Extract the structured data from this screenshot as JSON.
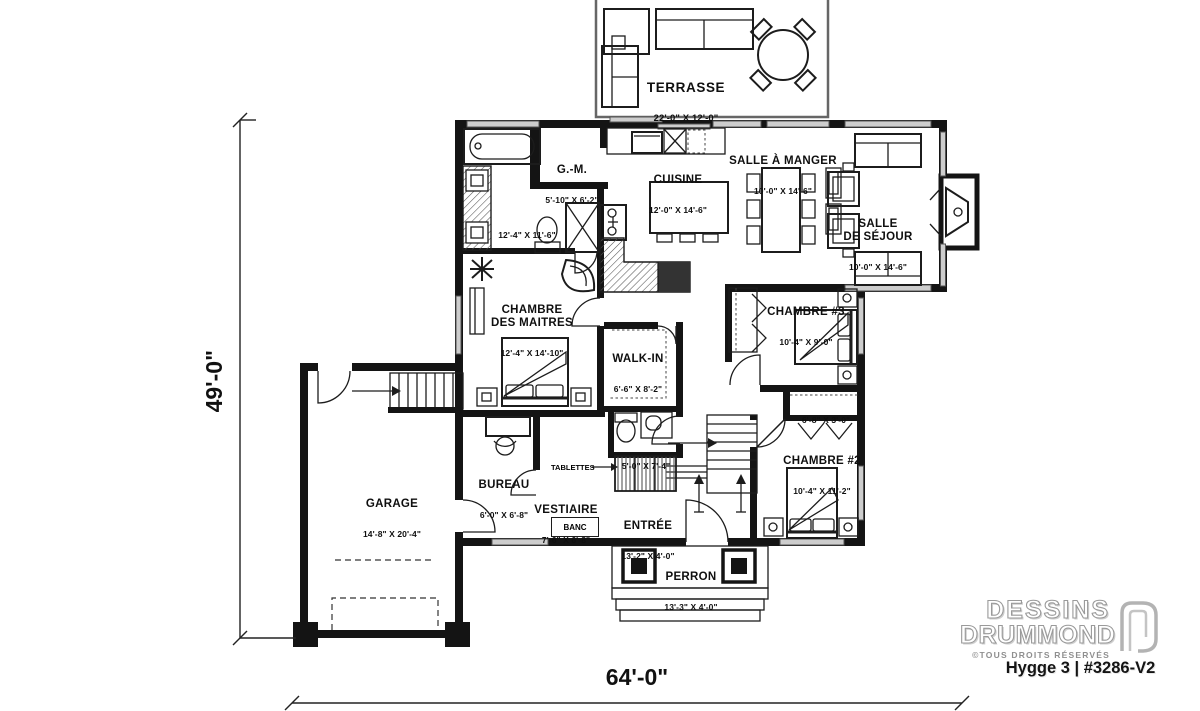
{
  "plan": {
    "rooms": {
      "terrasse": {
        "name": "TERRASSE",
        "dims": "22'-0\" X 12'-0\""
      },
      "gm": {
        "name": "G.-M.",
        "dims": "5'-10\" X 6'-2\""
      },
      "cuisine": {
        "name": "CUISINE",
        "dims": "12'-0\" X 14'-6\""
      },
      "salle_a_manger": {
        "name": "SALLE À MANGER",
        "dims": "10'-0\" X 14'-6\""
      },
      "salle_de_sejour": {
        "name": "SALLE\nDE SÉJOUR",
        "dims": "10'-0\" X 14'-6\""
      },
      "salle_de_bain": {
        "name": "",
        "dims": "12'-4\" X 11'-6\""
      },
      "chambre_maitres": {
        "name": "CHAMBRE\nDES MAITRES",
        "dims": "12'-4\" X 14'-10\""
      },
      "walk_in": {
        "name": "WALK-IN",
        "dims": "6'-6\" X 8'-2\""
      },
      "chambre3": {
        "name": "CHAMBRE #3",
        "dims": "10'-4\" X 9'-0\""
      },
      "placard": {
        "name": "",
        "dims": "6'-8\" X 3'-0\""
      },
      "chambre2": {
        "name": "CHAMBRE #2",
        "dims": "10'-4\" X 11'-2\""
      },
      "salle_eau": {
        "name": "",
        "dims": "5'-0\" X 7'-4\""
      },
      "bureau": {
        "name": "BUREAU",
        "dims": "6'-0\" X 6'-8\""
      },
      "vestiaire": {
        "name": "VESTIAIRE",
        "dims": "7'-6\" X 6'-8\""
      },
      "entree": {
        "name": "ENTRÉE",
        "dims": "13'-2\" X 4'-0\""
      },
      "garage": {
        "name": "GARAGE",
        "dims": "14'-8\" X 20'-4\""
      },
      "perron": {
        "name": "PERRON",
        "dims": "13'-3\" X 4'-0\""
      }
    },
    "annotations": {
      "tablettes": "TABLETTES",
      "banc": "BANC"
    },
    "overall_dimensions": {
      "width": "64'-0\"",
      "height": "49'-0\""
    }
  },
  "branding": {
    "line1": "DESSINS",
    "line2": "DRUMMOND",
    "rights": "©TOUS DROITS RÉSERVÉS",
    "model": "Hygge 3 | #3286-V2"
  },
  "colors": {
    "wall": "#141414",
    "window": "#cdcdcd",
    "background": "#ffffff"
  }
}
